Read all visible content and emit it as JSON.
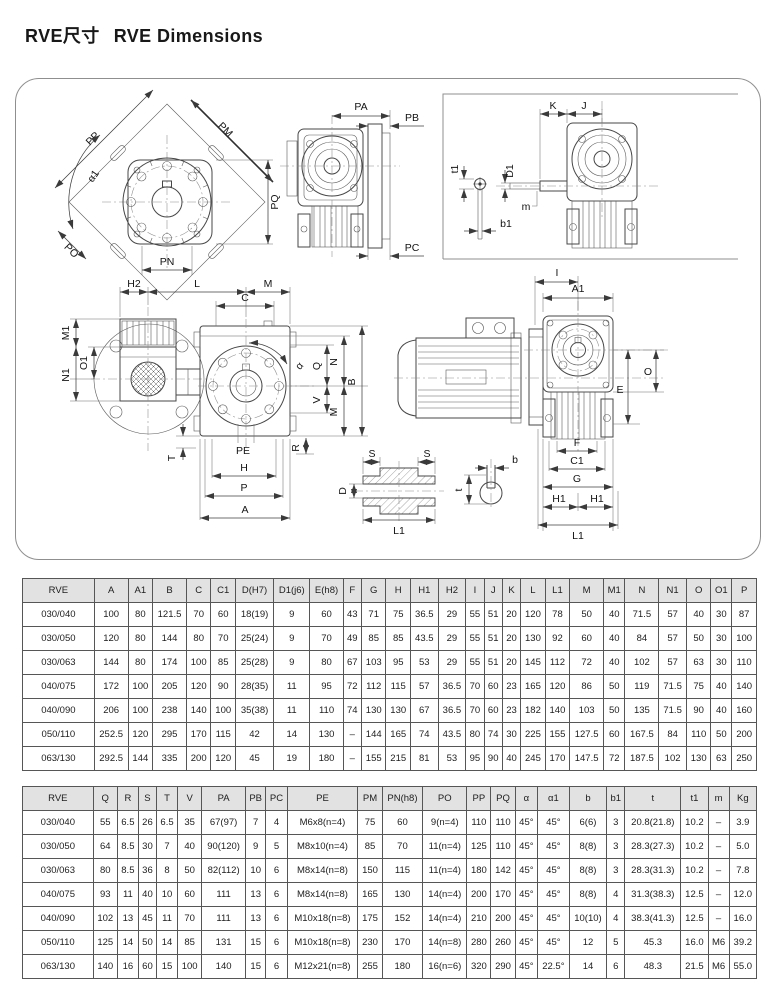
{
  "page": {
    "title_cn": "RVE尺寸",
    "title_en": "RVE Dimensions"
  },
  "drawings": {
    "labels": {
      "pp": "PP",
      "pm": "PM",
      "alpha1": "α1",
      "pq": "PQ",
      "po": "PO",
      "pn": "PN",
      "pa": "PA",
      "pb": "PB",
      "pc": "PC",
      "k": "K",
      "j": "J",
      "t1": "t1",
      "d1": "D1",
      "m_small": "m",
      "b1": "b1",
      "i": "I",
      "a1": "A1",
      "o": "O",
      "e": "E",
      "f": "F",
      "c1": "C1",
      "g": "G",
      "h1a": "H1",
      "h1b": "H1",
      "l1_view4": "L1",
      "h2": "H2",
      "l": "L",
      "m_top": "M",
      "c": "C",
      "m1": "M1",
      "o1": "O1",
      "n1": "N1",
      "q": "Q",
      "n": "N",
      "b_cap": "B",
      "v": "V",
      "m_side": "M",
      "alpha": "α",
      "pe": "PE",
      "t_cap": "T",
      "h": "H",
      "p": "P",
      "a": "A",
      "r": "R",
      "s_left": "S",
      "s_right": "S",
      "d": "D",
      "l1_shaft": "L1",
      "b_key": "b",
      "t_key": "t"
    }
  },
  "table1": {
    "headers": [
      "RVE",
      "A",
      "A1",
      "B",
      "C",
      "C1",
      "D(H7)",
      "D1(j6)",
      "E(h8)",
      "F",
      "G",
      "H",
      "H1",
      "H2",
      "I",
      "J",
      "K",
      "L",
      "L1",
      "M",
      "M1",
      "N",
      "N1",
      "O",
      "O1",
      "P"
    ],
    "rows": [
      [
        "030/040",
        "100",
        "80",
        "121.5",
        "70",
        "60",
        "18(19)",
        "9",
        "60",
        "43",
        "71",
        "75",
        "36.5",
        "29",
        "55",
        "51",
        "20",
        "120",
        "78",
        "50",
        "40",
        "71.5",
        "57",
        "40",
        "30",
        "87"
      ],
      [
        "030/050",
        "120",
        "80",
        "144",
        "80",
        "70",
        "25(24)",
        "9",
        "70",
        "49",
        "85",
        "85",
        "43.5",
        "29",
        "55",
        "51",
        "20",
        "130",
        "92",
        "60",
        "40",
        "84",
        "57",
        "50",
        "30",
        "100"
      ],
      [
        "030/063",
        "144",
        "80",
        "174",
        "100",
        "85",
        "25(28)",
        "9",
        "80",
        "67",
        "103",
        "95",
        "53",
        "29",
        "55",
        "51",
        "20",
        "145",
        "112",
        "72",
        "40",
        "102",
        "57",
        "63",
        "30",
        "110"
      ],
      [
        "040/075",
        "172",
        "100",
        "205",
        "120",
        "90",
        "28(35)",
        "11",
        "95",
        "72",
        "112",
        "115",
        "57",
        "36.5",
        "70",
        "60",
        "23",
        "165",
        "120",
        "86",
        "50",
        "119",
        "71.5",
        "75",
        "40",
        "140"
      ],
      [
        "040/090",
        "206",
        "100",
        "238",
        "140",
        "100",
        "35(38)",
        "11",
        "110",
        "74",
        "130",
        "130",
        "67",
        "36.5",
        "70",
        "60",
        "23",
        "182",
        "140",
        "103",
        "50",
        "135",
        "71.5",
        "90",
        "40",
        "160"
      ],
      [
        "050/110",
        "252.5",
        "120",
        "295",
        "170",
        "115",
        "42",
        "14",
        "130",
        "–",
        "144",
        "165",
        "74",
        "43.5",
        "80",
        "74",
        "30",
        "225",
        "155",
        "127.5",
        "60",
        "167.5",
        "84",
        "110",
        "50",
        "200"
      ],
      [
        "063/130",
        "292.5",
        "144",
        "335",
        "200",
        "120",
        "45",
        "19",
        "180",
        "–",
        "155",
        "215",
        "81",
        "53",
        "95",
        "90",
        "40",
        "245",
        "170",
        "147.5",
        "72",
        "187.5",
        "102",
        "130",
        "63",
        "250"
      ]
    ]
  },
  "table2": {
    "headers": [
      "RVE",
      "Q",
      "R",
      "S",
      "T",
      "V",
      "PA",
      "PB",
      "PC",
      "PE",
      "PM",
      "PN(h8)",
      "PO",
      "PP",
      "PQ",
      "α",
      "α1",
      "b",
      "b1",
      "t",
      "t1",
      "m",
      "Kg"
    ],
    "rows": [
      [
        "030/040",
        "55",
        "6.5",
        "26",
        "6.5",
        "35",
        "67(97)",
        "7",
        "4",
        "M6x8(n=4)",
        "75",
        "60",
        "9(n=4)",
        "110",
        "110",
        "45°",
        "45°",
        "6(6)",
        "3",
        "20.8(21.8)",
        "10.2",
        "–",
        "3.9"
      ],
      [
        "030/050",
        "64",
        "8.5",
        "30",
        "7",
        "40",
        "90(120)",
        "9",
        "5",
        "M8x10(n=4)",
        "85",
        "70",
        "11(n=4)",
        "125",
        "110",
        "45°",
        "45°",
        "8(8)",
        "3",
        "28.3(27.3)",
        "10.2",
        "–",
        "5.0"
      ],
      [
        "030/063",
        "80",
        "8.5",
        "36",
        "8",
        "50",
        "82(112)",
        "10",
        "6",
        "M8x14(n=8)",
        "150",
        "115",
        "11(n=4)",
        "180",
        "142",
        "45°",
        "45°",
        "8(8)",
        "3",
        "28.3(31.3)",
        "10.2",
        "–",
        "7.8"
      ],
      [
        "040/075",
        "93",
        "11",
        "40",
        "10",
        "60",
        "111",
        "13",
        "6",
        "M8x14(n=8)",
        "165",
        "130",
        "14(n=4)",
        "200",
        "170",
        "45°",
        "45°",
        "8(8)",
        "4",
        "31.3(38.3)",
        "12.5",
        "–",
        "12.0"
      ],
      [
        "040/090",
        "102",
        "13",
        "45",
        "11",
        "70",
        "111",
        "13",
        "6",
        "M10x18(n=8)",
        "175",
        "152",
        "14(n=4)",
        "210",
        "200",
        "45°",
        "45°",
        "10(10)",
        "4",
        "38.3(41.3)",
        "12.5",
        "–",
        "16.0"
      ],
      [
        "050/110",
        "125",
        "14",
        "50",
        "14",
        "85",
        "131",
        "15",
        "6",
        "M10x18(n=8)",
        "230",
        "170",
        "14(n=8)",
        "280",
        "260",
        "45°",
        "45°",
        "12",
        "5",
        "45.3",
        "16.0",
        "M6",
        "39.2"
      ],
      [
        "063/130",
        "140",
        "16",
        "60",
        "15",
        "100",
        "140",
        "15",
        "6",
        "M12x21(n=8)",
        "255",
        "180",
        "16(n=6)",
        "320",
        "290",
        "45°",
        "22.5°",
        "14",
        "6",
        "48.3",
        "21.5",
        "M6",
        "55.0"
      ]
    ]
  }
}
